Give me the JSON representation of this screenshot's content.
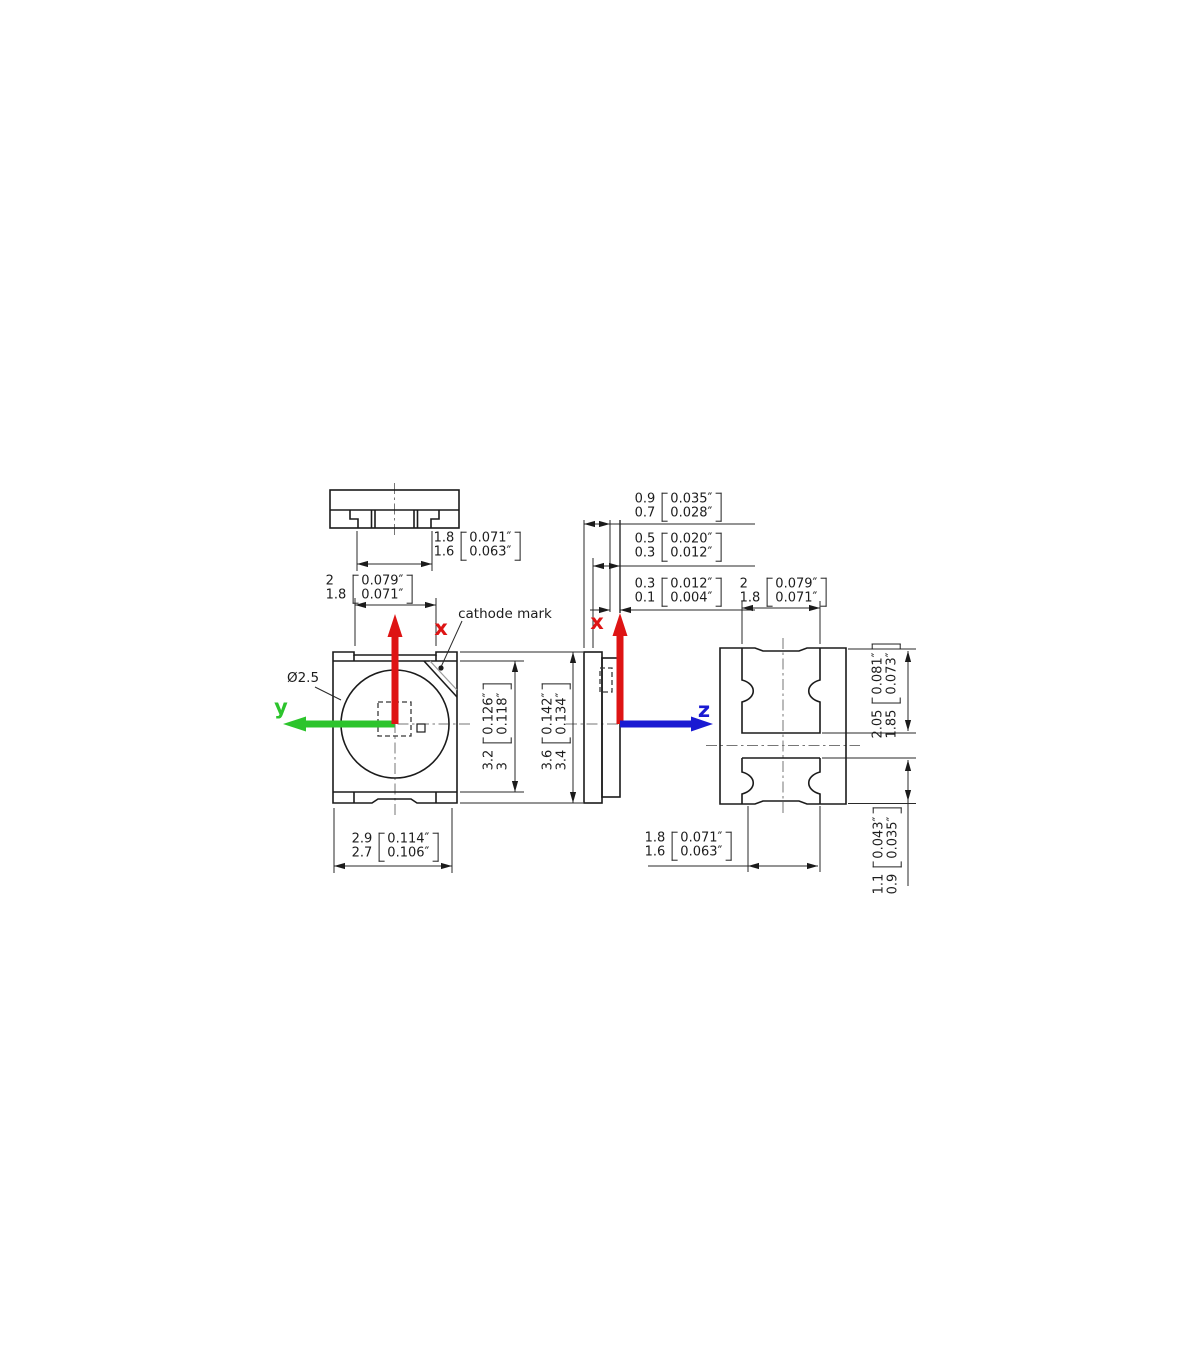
{
  "labels": {
    "cathode_mark": "cathode mark",
    "lens_diameter": "Ø2.5",
    "axis_x": "x",
    "axis_y": "y",
    "axis_z": "z"
  },
  "dims": {
    "top_view_width": {
      "mm": [
        "1.8",
        "1.6"
      ],
      "in": [
        "0.071″",
        "0.063″"
      ]
    },
    "front_top_width": {
      "mm": [
        "2",
        "1.8"
      ],
      "in": [
        "0.079″",
        "0.071″"
      ]
    },
    "front_bottom_width": {
      "mm": [
        "2.9",
        "2.7"
      ],
      "in": [
        "0.114″",
        "0.106″"
      ]
    },
    "front_height_inner": {
      "mm": [
        "3.2",
        "3"
      ],
      "in": [
        "0.126″",
        "0.118″"
      ]
    },
    "front_height_outer": {
      "mm": [
        "3.6",
        "3.4"
      ],
      "in": [
        "0.142″",
        "0.134″"
      ]
    },
    "side_thickness": {
      "mm": [
        "0.9",
        "0.7"
      ],
      "in": [
        "0.035″",
        "0.028″"
      ]
    },
    "side_lead": {
      "mm": [
        "0.5",
        "0.3"
      ],
      "in": [
        "0.020″",
        "0.012″"
      ]
    },
    "side_standoff": {
      "mm": [
        "0.3",
        "0.1"
      ],
      "in": [
        "0.012″",
        "0.004″"
      ]
    },
    "back_top_width": {
      "mm": [
        "2",
        "1.8"
      ],
      "in": [
        "0.079″",
        "0.071″"
      ]
    },
    "back_upper_pad_height": {
      "mm": [
        "2.05",
        "1.85"
      ],
      "in": [
        "0.081″",
        "0.073″"
      ]
    },
    "back_bottom_width": {
      "mm": [
        "1.8",
        "1.6"
      ],
      "in": [
        "0.071″",
        "0.063″"
      ]
    },
    "back_lower_pad_height": {
      "mm": [
        "1.1",
        "0.9"
      ],
      "in": [
        "0.043″",
        "0.035″"
      ]
    }
  },
  "colors": {
    "axis_x": "#de1414",
    "axis_y": "#2cc42c",
    "axis_z": "#1a1ad2",
    "line": "#1b1b1b"
  }
}
